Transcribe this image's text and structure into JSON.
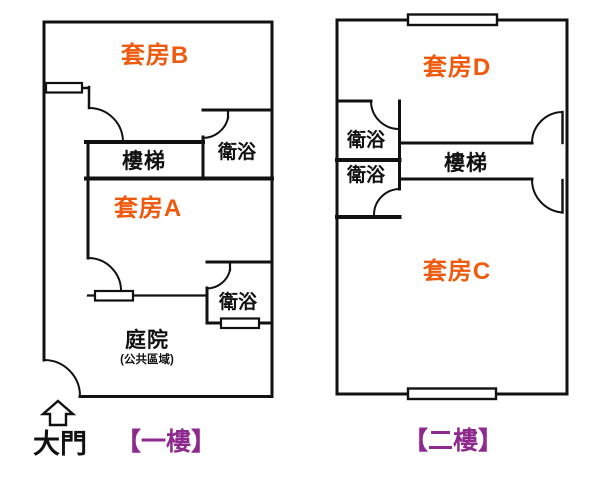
{
  "colors": {
    "suite_text": "#ef5a0e",
    "caption_text": "#8e2a8e",
    "wall": "#111111"
  },
  "icons": {
    "gate_arrow_icon": "hollow-up-arrow"
  },
  "floor1": {
    "suite_b": "套房B",
    "suite_a": "套房A",
    "stairs": "樓梯",
    "bath_top": "衛浴",
    "bath_bottom": "衛浴",
    "courtyard": "庭院",
    "courtyard_note": "(公共區域)",
    "gate": "大門",
    "caption": "【一樓】"
  },
  "floor2": {
    "suite_d": "套房D",
    "suite_c": "套房C",
    "stairs": "樓梯",
    "bath_top": "衛浴",
    "bath_bottom": "衛浴",
    "caption": "【二樓】"
  }
}
